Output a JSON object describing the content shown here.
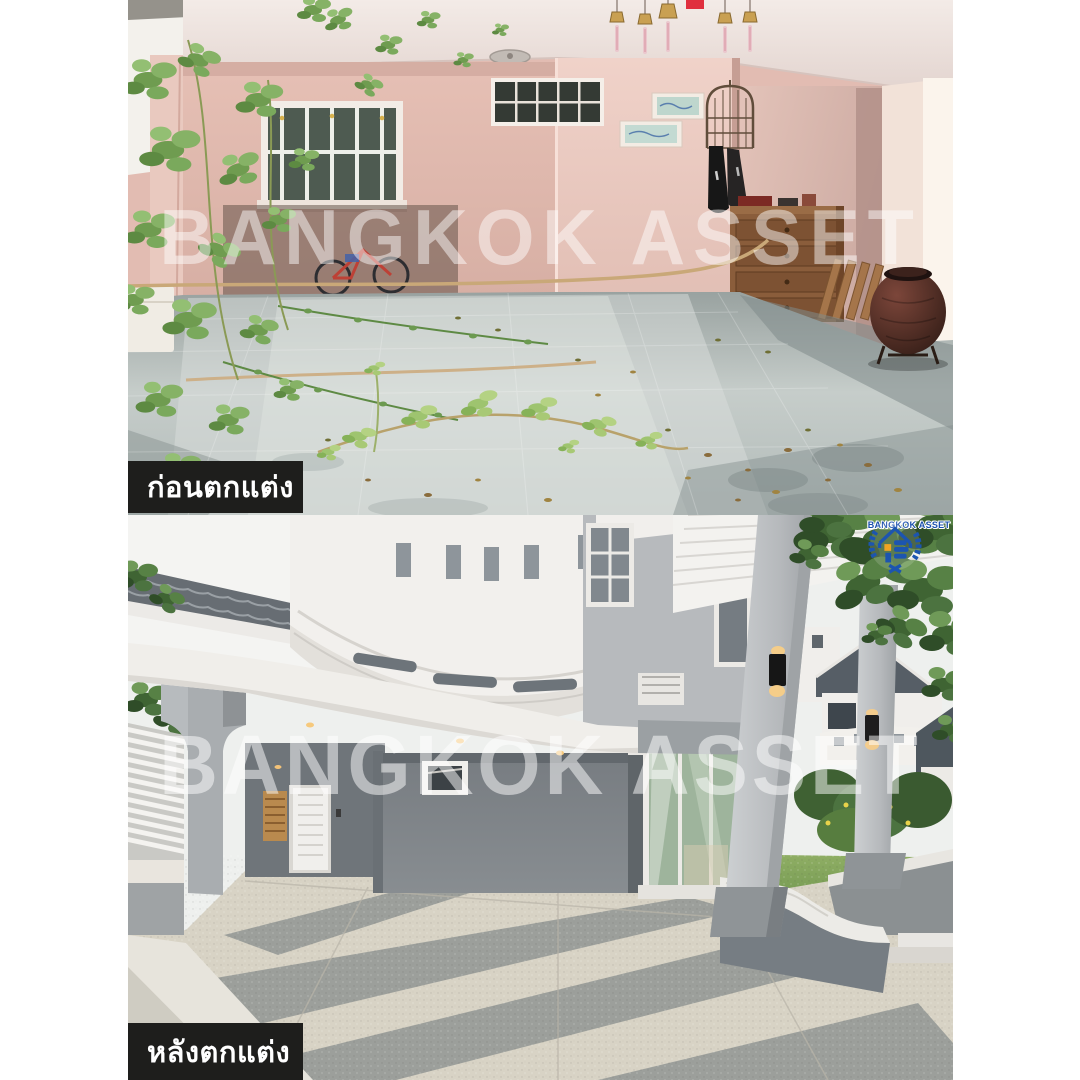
{
  "page": {
    "width": 1080,
    "height": 1080,
    "background": "#ffffff"
  },
  "watermark": {
    "text": "BANGKOK ASSET",
    "color": "rgba(255,255,255,0.5)"
  },
  "sections": {
    "before": {
      "label": "ก่อนตกแต่ง",
      "label_bg": "#1e1e1c",
      "label_color": "#ffffff"
    },
    "after": {
      "label": "หลังตกแต่ง",
      "label_bg": "#1e1e1c",
      "label_color": "#ffffff"
    }
  },
  "logo": {
    "text": "BANGKOK ASSET",
    "blue": "#1b50ad",
    "orange": "#f0a422"
  }
}
